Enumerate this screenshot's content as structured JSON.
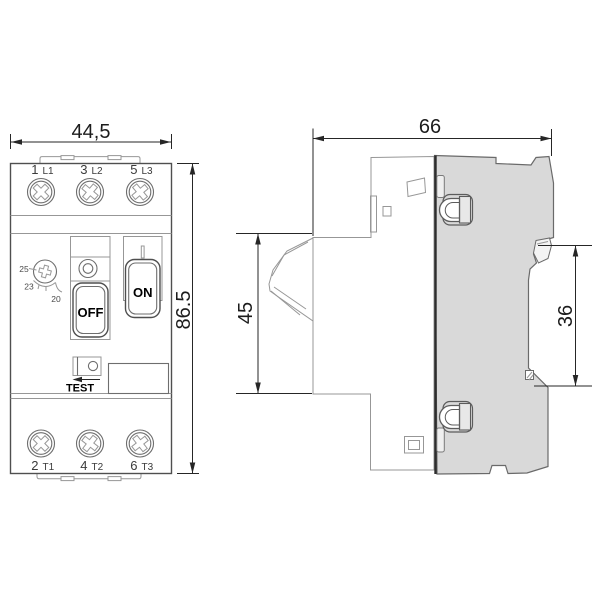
{
  "front_view": {
    "dim_width": "44,5",
    "dim_height": "86.5",
    "terminals_top": [
      {
        "num": "1",
        "phase": "L1"
      },
      {
        "num": "3",
        "phase": "L2"
      },
      {
        "num": "5",
        "phase": "L3"
      }
    ],
    "terminals_bottom": [
      {
        "num": "2",
        "phase": "T1"
      },
      {
        "num": "4",
        "phase": "T2"
      },
      {
        "num": "6",
        "phase": "T3"
      }
    ],
    "dial_marks": [
      "25",
      "23",
      "20"
    ],
    "off_label": "OFF",
    "on_label": "ON",
    "test_label": "TEST"
  },
  "side_view": {
    "dim_depth": "66",
    "dim_handle_height": "45",
    "dim_rail_span": "36"
  },
  "colors": {
    "line_dark": "#2e2e2e",
    "line_medium": "#6e6e6e",
    "line_light": "#979797",
    "dimension": "#262626",
    "side_body_fill": "#d9d9d9",
    "background": "#ffffff"
  }
}
